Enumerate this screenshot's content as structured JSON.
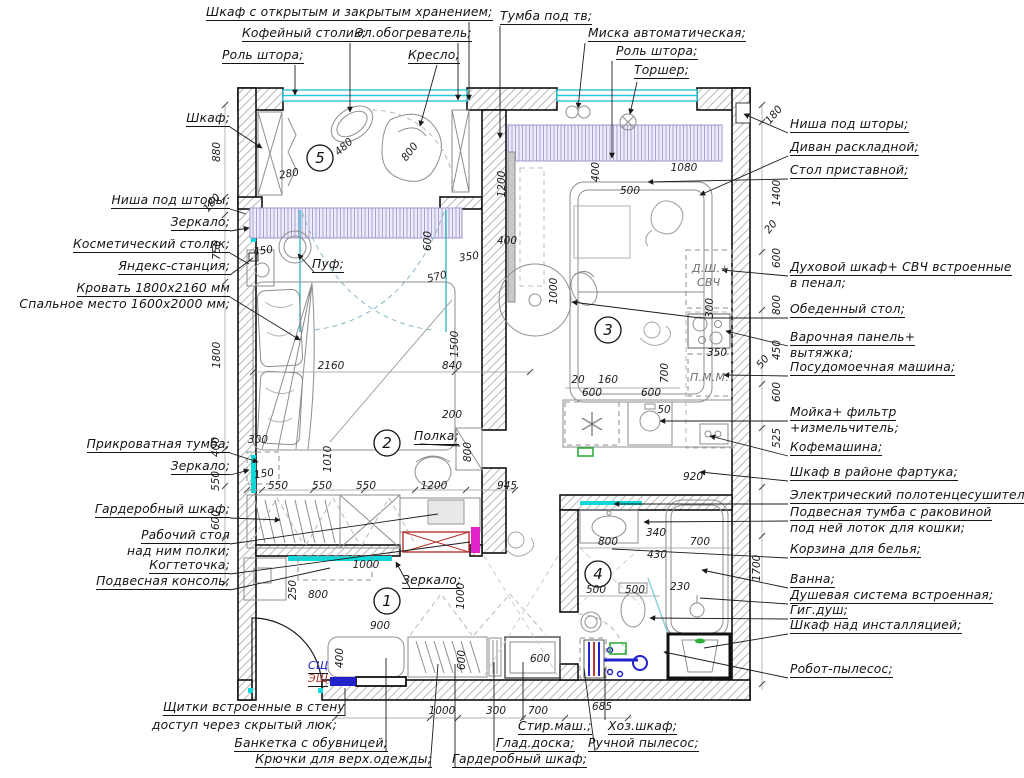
{
  "labels": {
    "top": [
      "Шкаф с открытым и закрытым хранением;",
      "Кофейный столик;",
      "Эл.обогреватель;",
      "Роль штора;",
      "Кресло;",
      "Тумба под тв;",
      "Миска автоматическая;",
      "Роль штора;",
      "Торшер;"
    ],
    "left": [
      "Шкаф;",
      "Ниша под шторы;",
      "Зеркало;",
      "Косметический столик;",
      "Яндекс-станция;",
      "Кровать 1800х2160 мм",
      "Спальное место 1600х2000 мм;",
      "Прикроватная тумба;",
      "Зеркало;",
      "Гардеробный шкаф;",
      "Рабочий стол",
      "над ним полки;",
      "Когтеточка;",
      "Подвесная консоль;"
    ],
    "right": [
      "Ниша под шторы;",
      "Диван раскладной;",
      "Стол приставной;",
      "Духовой шкаф+ СВЧ встроенные",
      "в пенал;",
      "Обеденный стол;",
      "Варочная панель+",
      "вытяжка;",
      "Посудомоечная машина;",
      "Мойка+ фильтр",
      "+измельчитель;",
      "Кофемашина;",
      "Шкаф в районе фартука;",
      "Электрический полотенцесушитель;",
      "Подвесная тумба с раковиной",
      "под ней лоток для кошки;",
      "Корзина для белья;",
      "Ванна;",
      "Душевая система встроенная;",
      "Гиг.душ;",
      "Шкаф над инсталляцией;",
      "Робот-пылесос;"
    ],
    "bottom": [
      "Щитки встроенные в стену",
      "доступ через скрытый люк;",
      "Банкетка с обувницей;",
      "Крючки для верх.одежды;",
      "Стир.маш.;",
      "Глад.доска;",
      "Гардеробный шкаф;",
      "Хоз.шкаф;",
      "Ручной пылесос;"
    ],
    "interior": {
      "pouf": "Пуф;",
      "shelf": "Полка;",
      "mirror": "Зеркало;",
      "oven_line1": "Д.Ш.+",
      "oven_line2": "СВЧ",
      "dishwasher": "П.М.М.",
      "panel_low_current": "СЩ",
      "panel_electric": "ЭЩ"
    }
  },
  "rooms": [
    "1",
    "2",
    "3",
    "4",
    "5"
  ],
  "dims": {
    "l880": "880",
    "l180": "180",
    "l750": "750",
    "l1800": "1800",
    "l400": "400",
    "l550": "550",
    "l600": "600",
    "r180": "180",
    "r1400": "1400",
    "r20": "20",
    "r600a": "600",
    "r800": "800",
    "r450": "450",
    "r50": "50",
    "r600b": "600",
    "r525": "525",
    "r1700": "1700",
    "b5_480": "480",
    "b5_800": "800",
    "b5_280": "280",
    "n450": "450",
    "n350": "350",
    "n600": "600",
    "n570": "570",
    "bed2160": "2160",
    "bed840": "840",
    "bed1500": "1500",
    "bed200": "200",
    "bed800": "800",
    "bed300": "300",
    "bed150": "150",
    "bed550a": "550",
    "bed550b": "550",
    "bed550c": "550",
    "bed1010": "1010",
    "bed1200": "1200",
    "bed945": "945",
    "k1200": "1200",
    "k400a": "400",
    "k500": "500",
    "k1080": "1080",
    "k400b": "400",
    "k1000": "1000",
    "k20": "20",
    "k160": "160",
    "k600a": "600",
    "k600b": "600",
    "k50": "50",
    "k300": "300",
    "k350": "350",
    "k700": "700",
    "k920": "920",
    "ba800": "800",
    "ba340": "340",
    "ba430": "430",
    "ba700": "700",
    "ba230": "230",
    "ba500a": "500",
    "ba500b": "500",
    "h250": "250",
    "h800": "800",
    "h1000": "1000",
    "h900": "900",
    "h400": "400",
    "h600a": "600",
    "h600b": "600",
    "h1000b": "1000",
    "bt1000": "1000",
    "bt300": "300",
    "bt700": "700",
    "bt685": "685"
  },
  "colors": {
    "window": "#29c5d6",
    "mirror": "#0fd8d8",
    "curtain": "#9b93cc",
    "curtain_fill": "#edecf8",
    "red": "#b8342e",
    "magenta": "#e421c8",
    "blue": "#2222cc",
    "green": "#2fae3a",
    "furniture": "#8e8e8e"
  }
}
